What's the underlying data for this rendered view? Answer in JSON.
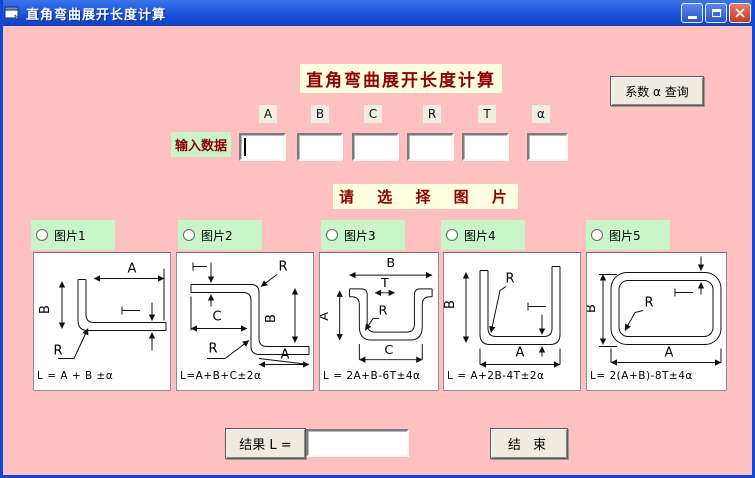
{
  "window": {
    "title": "直角弯曲展开长度计算",
    "controls": [
      "minimize-icon",
      "maximize-icon",
      "close-icon"
    ]
  },
  "header": {
    "title": "直角弯曲展开长度计算",
    "lookup_button": "系数 α 查询"
  },
  "inputs": {
    "label": "输入数据",
    "fields": [
      "A",
      "B",
      "C",
      "R",
      "T",
      "α"
    ],
    "values": [
      "",
      "",
      "",
      "",
      "",
      ""
    ]
  },
  "picker": {
    "heading": "请 选 择 图 片",
    "options": [
      {
        "label": "图片1",
        "selected": false,
        "formula": "L = A + B ±α",
        "dims": {
          "a": "A",
          "b": "B",
          "r": "R"
        }
      },
      {
        "label": "图片2",
        "selected": false,
        "formula": "L=A+B+C±2α",
        "dims": {
          "r1": "R",
          "c": "C",
          "b": "B",
          "r2": "R",
          "a": "A"
        }
      },
      {
        "label": "图片3",
        "selected": false,
        "formula": "L = 2A+B-6T±4α",
        "dims": {
          "b": "B",
          "t": "T",
          "r": "R",
          "a": "A",
          "c": "C"
        }
      },
      {
        "label": "图片4",
        "selected": false,
        "formula": "L = A+2B-4T±2α",
        "dims": {
          "b": "B",
          "r": "R",
          "a": "A"
        }
      },
      {
        "label": "图片5",
        "selected": false,
        "formula": "L= 2(A+B)-8T±4α",
        "dims": {
          "b": "B",
          "r": "R",
          "a": "A"
        }
      }
    ]
  },
  "result": {
    "label": "结果  L =",
    "value": ""
  },
  "end_button": {
    "label": "结  束"
  },
  "colors": {
    "client_background": "#ffc0c0",
    "label_green": "#c9f6c9",
    "highlight_ivory": "#ffffe1",
    "title_text": "#900000",
    "titlebar_blue": "#1c55dc",
    "button_face": "#efecdf"
  }
}
